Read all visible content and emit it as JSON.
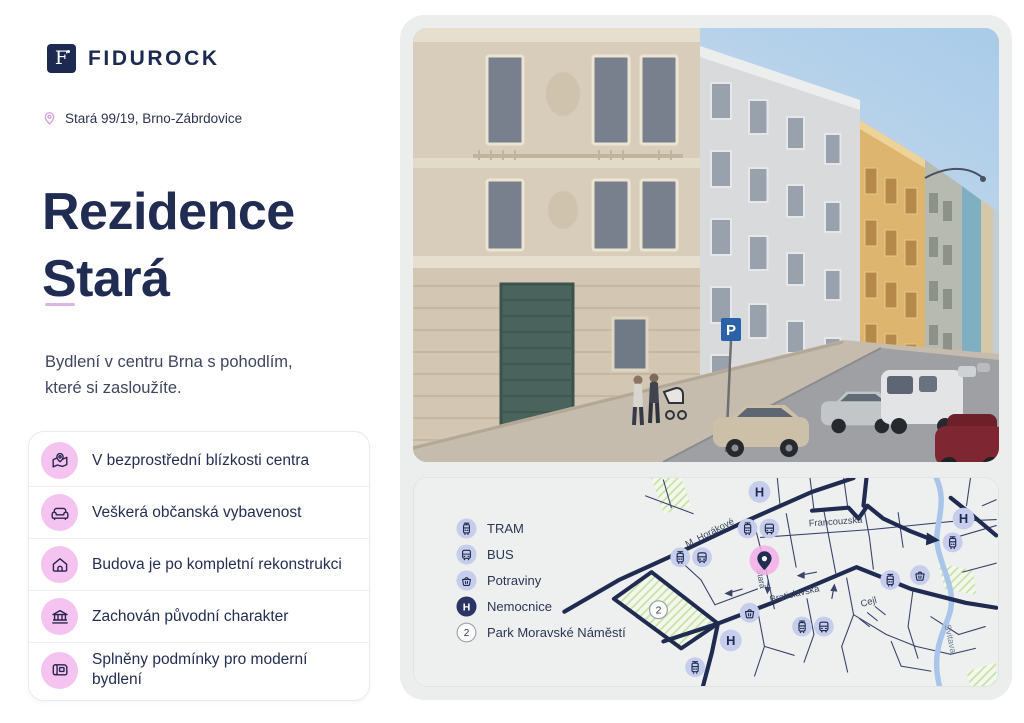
{
  "brand": {
    "wordmark": "FIDUROCK",
    "logo_letter": "F"
  },
  "header": {
    "location": "Stará 99/19, Brno-Zábrdovice"
  },
  "hero": {
    "title_line1": "Rezidence",
    "title_line2": "Stará",
    "tagline_line1": "Bydlení v centru Brna s pohodlím,",
    "tagline_line2": "které si zasloužíte."
  },
  "features": [
    {
      "icon": "map-pin-icon",
      "label": "V bezprostřední blízkosti centra"
    },
    {
      "icon": "sofa-icon",
      "label": "Veškerá občanská vybavenost"
    },
    {
      "icon": "house-icon",
      "label": "Budova je po kompletní rekonstrukci"
    },
    {
      "icon": "bank-icon",
      "label": "Zachován původní charakter"
    },
    {
      "icon": "blueprint-icon",
      "label": "Splněny podmínky pro moderní bydlení"
    }
  ],
  "photo": {
    "parking_sign": "P"
  },
  "map": {
    "legend": [
      {
        "icon": "tram-icon",
        "label": "TRAM"
      },
      {
        "icon": "bus-icon",
        "label": "BUS"
      },
      {
        "icon": "grocery-icon",
        "label": "Potraviny"
      },
      {
        "icon": "hospital-icon",
        "label": "Nemocnice",
        "glyph": "H"
      },
      {
        "icon": "park-number-icon",
        "label": "Park Moravské Náměstí",
        "number": "2"
      }
    ],
    "street_labels": [
      "M. Horákové",
      "Francouzská",
      "Stará",
      "Bratislavská",
      "Cejl",
      "Svitava"
    ],
    "markers": [
      {
        "type": "hospital",
        "x": 347,
        "y": 14,
        "label": "H"
      },
      {
        "type": "hospital",
        "x": 553,
        "y": 41,
        "label": "H"
      },
      {
        "type": "hospital",
        "x": 318,
        "y": 164,
        "label": "H"
      },
      {
        "type": "tram",
        "x": 335,
        "y": 51
      },
      {
        "type": "bus",
        "x": 357,
        "y": 51
      },
      {
        "type": "tram",
        "x": 267,
        "y": 80
      },
      {
        "type": "bus",
        "x": 289,
        "y": 80
      },
      {
        "type": "tram",
        "x": 542,
        "y": 65
      },
      {
        "type": "tram",
        "x": 479,
        "y": 103
      },
      {
        "type": "grocery",
        "x": 509,
        "y": 98
      },
      {
        "type": "grocery",
        "x": 337,
        "y": 136
      },
      {
        "type": "tram",
        "x": 390,
        "y": 150
      },
      {
        "type": "bus",
        "x": 412,
        "y": 150
      },
      {
        "type": "tram",
        "x": 282,
        "y": 191
      },
      {
        "type": "park",
        "x": 245,
        "y": 133,
        "label": "2"
      },
      {
        "type": "pin",
        "x": 352,
        "y": 83
      }
    ]
  },
  "colors": {
    "navy": "#212C52",
    "road_navy": "#1F2B50",
    "pink_circle": "#F5C3EF",
    "pin_pink": "#F3AEE7",
    "lavender_marker": "#C7CDEC",
    "hospital_navy": "#2A3565",
    "divider_pink": "#DCB8E6",
    "panel_gray": "#EBEEED",
    "map_bg": "#EDF0EE",
    "river_blue": "#A9C6EA",
    "park_hatch": "#C5E2A3"
  }
}
